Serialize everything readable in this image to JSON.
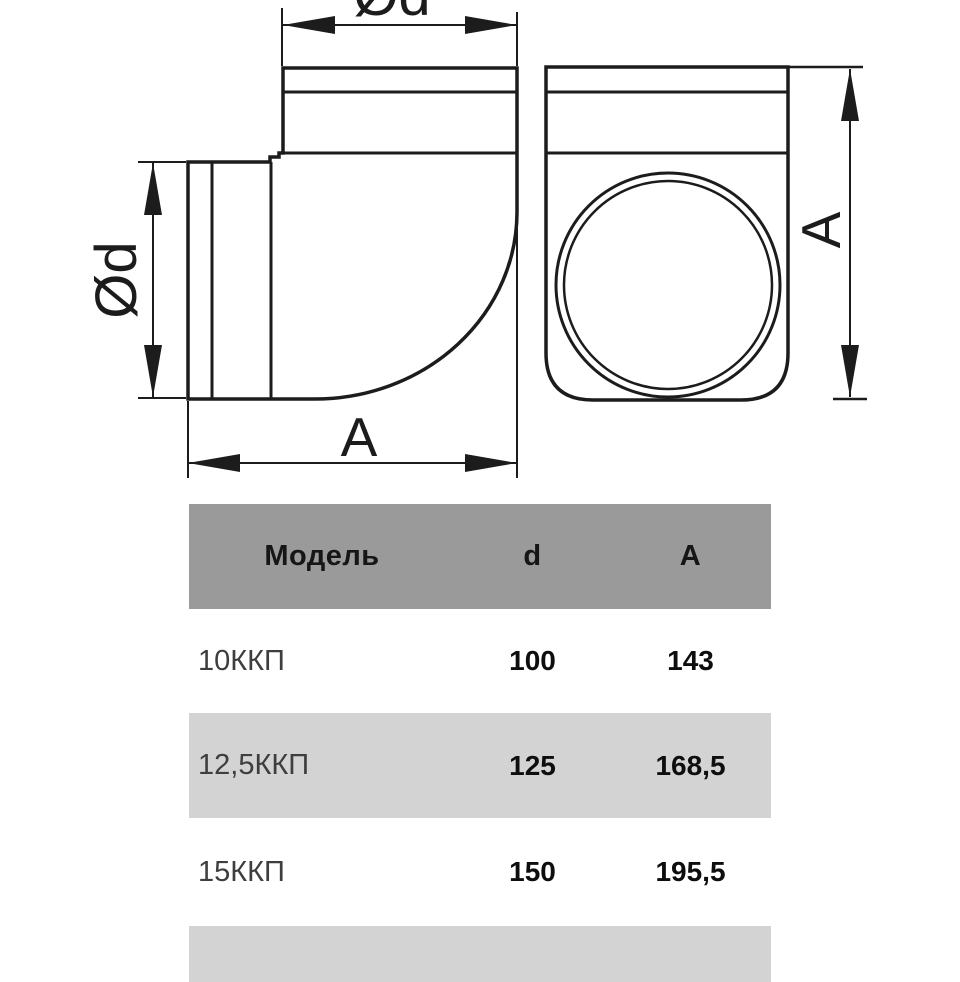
{
  "drawing": {
    "line_color": "#1c1c1c",
    "labels": {
      "top_diameter": "Ød",
      "left_diameter": "Ød",
      "bottom_length": "A",
      "right_height": "A"
    }
  },
  "table": {
    "colors": {
      "header_bg": "#9a9a9a",
      "stripe_bg": "#d3d3d3",
      "row_bg": "#ffffff"
    },
    "header": {
      "model": "Модель",
      "d": "d",
      "a": "A"
    },
    "rows": [
      {
        "model": "10ККП",
        "d": "100",
        "a": "143"
      },
      {
        "model": "12,5ККП",
        "d": "125",
        "a": "168,5"
      },
      {
        "model": "15ККП",
        "d": "150",
        "a": "195,5"
      }
    ]
  }
}
